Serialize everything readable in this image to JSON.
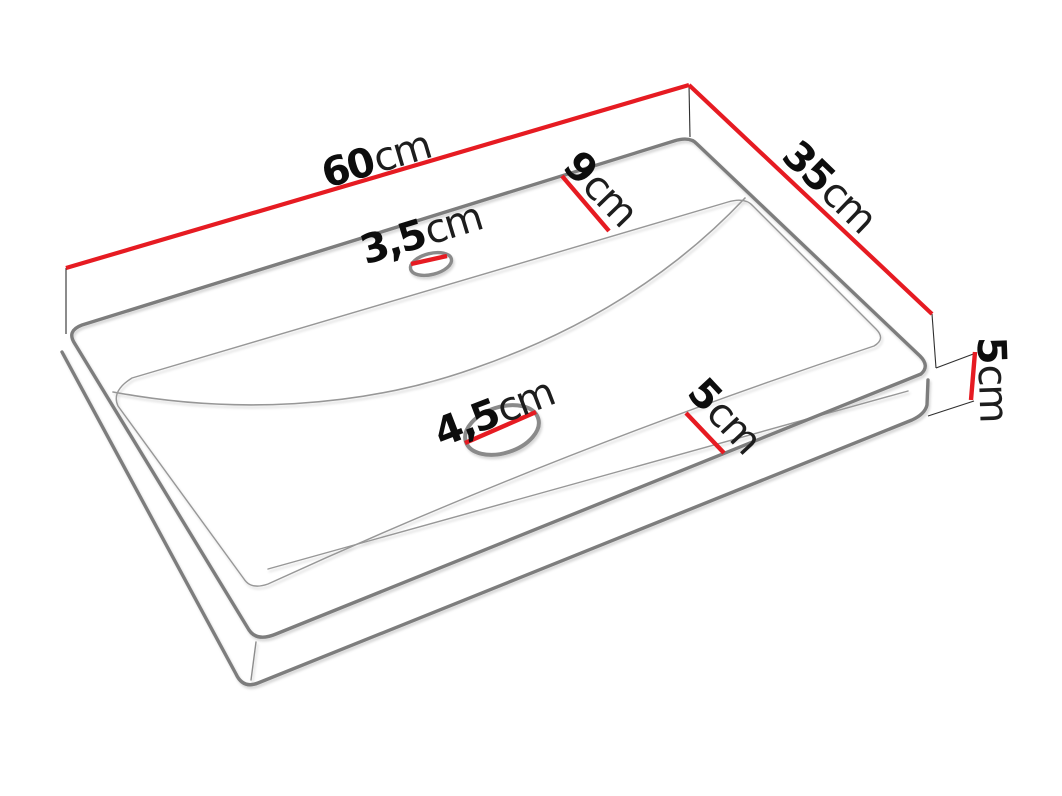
{
  "diagram": {
    "title": "Washbasin dimension diagram",
    "object": "rectangular countertop washbasin, perspective line drawing",
    "colors": {
      "dimension_red": "#e61b22",
      "edge_gray": "#7d7d7d",
      "inner_line_gray": "#979797",
      "label_dark": "#0d0d0d",
      "background": "#ffffff"
    },
    "dimensions": {
      "width": {
        "value": "60",
        "unit": "cm"
      },
      "depth": {
        "value": "35",
        "unit": "cm"
      },
      "back_ledge": {
        "value": "9",
        "unit": "cm"
      },
      "faucet_hole": {
        "value": "3,5",
        "unit": "cm"
      },
      "drain_hole": {
        "value": "4,5",
        "unit": "cm"
      },
      "front_ledge": {
        "value": "5",
        "unit": "cm"
      },
      "height": {
        "value": "5",
        "unit": "cm"
      }
    }
  }
}
